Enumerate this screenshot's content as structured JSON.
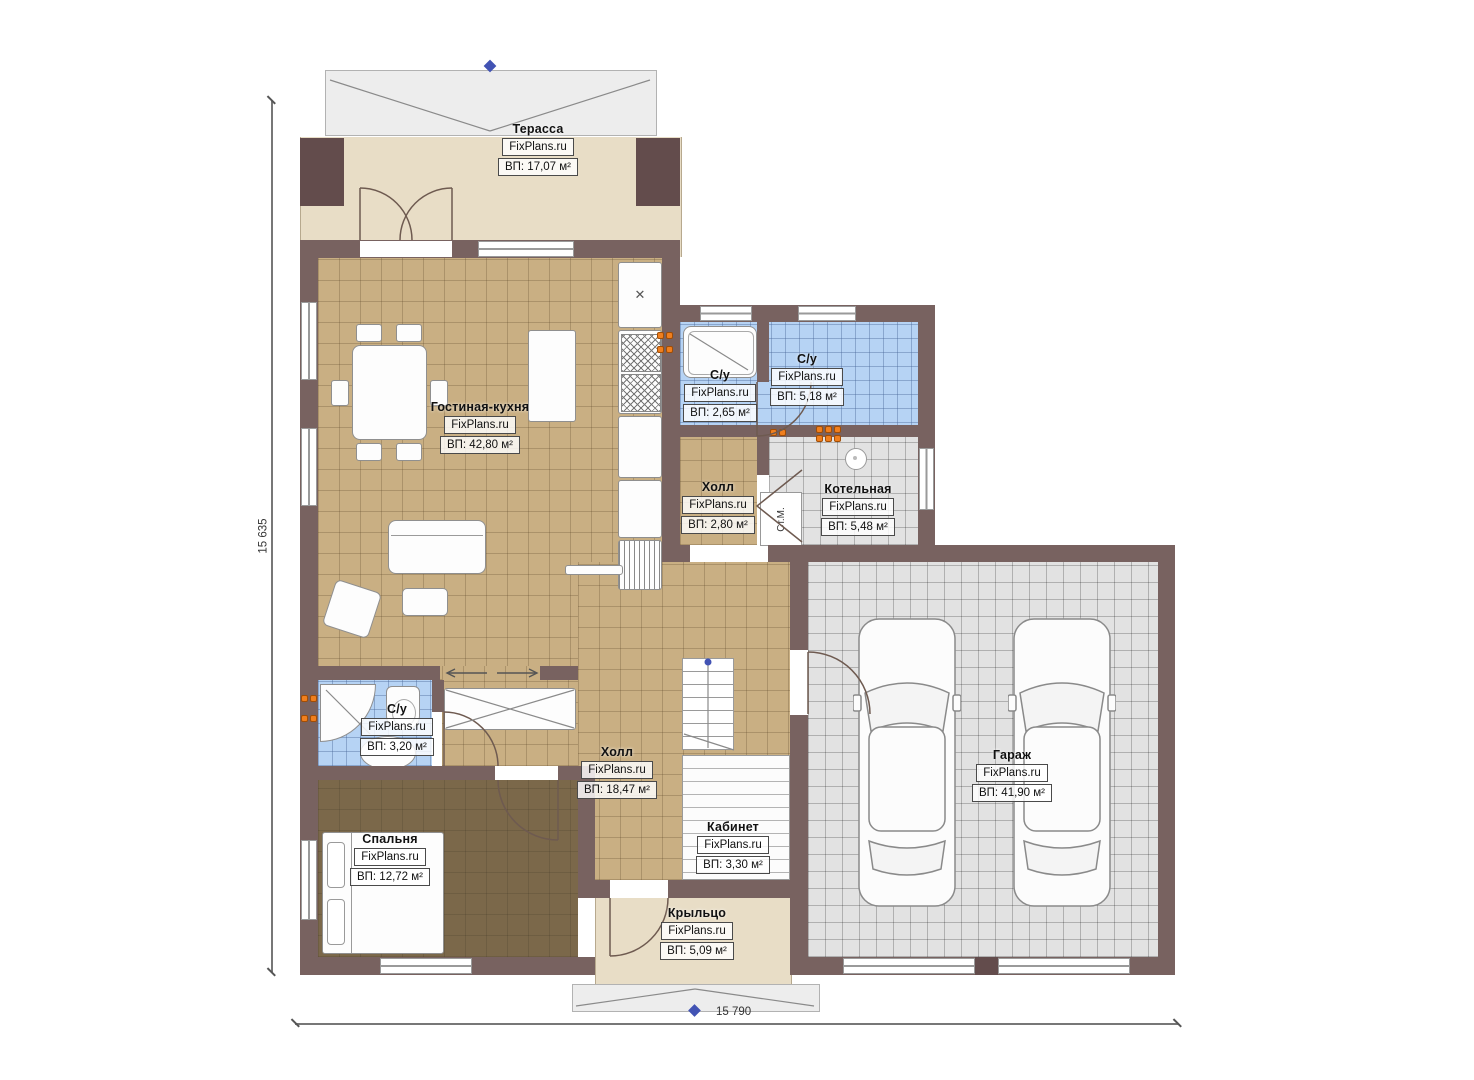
{
  "brand": "FixPlans.ru",
  "dimensions": {
    "left": "15 635",
    "bottom": "15 790"
  },
  "labels": {
    "washer": "Ст.М."
  },
  "rooms": {
    "terrace": {
      "name": "Терасса",
      "area": "ВП: 17,07 м²"
    },
    "living": {
      "name": "Гостиная-кухня",
      "area": "ВП: 42,80 м²"
    },
    "wc_small": {
      "name": "С/у",
      "area": "ВП: 2,65 м²"
    },
    "wc_large": {
      "name": "С/у",
      "area": "ВП: 5,18 м²"
    },
    "hall_small": {
      "name": "Холл",
      "area": "ВП: 2,80 м²"
    },
    "boiler": {
      "name": "Котельная",
      "area": "ВП: 5,48 м²"
    },
    "wc_master": {
      "name": "С/у",
      "area": "ВП: 3,20 м²"
    },
    "hall_main": {
      "name": "Холл",
      "area": "ВП: 18,47 м²"
    },
    "office": {
      "name": "Кабинет",
      "area": "ВП: 3,30 м²"
    },
    "bedroom": {
      "name": "Спальня",
      "area": "ВП: 12,72 м²"
    },
    "porch": {
      "name": "Крыльцо",
      "area": "ВП: 5,09 м²"
    },
    "garage": {
      "name": "Гараж",
      "area": "ВП: 41,90 м²"
    }
  },
  "colors": {
    "wall": "#786260",
    "accent_marker": "#4253b4",
    "radiator": "#f07f1e"
  }
}
